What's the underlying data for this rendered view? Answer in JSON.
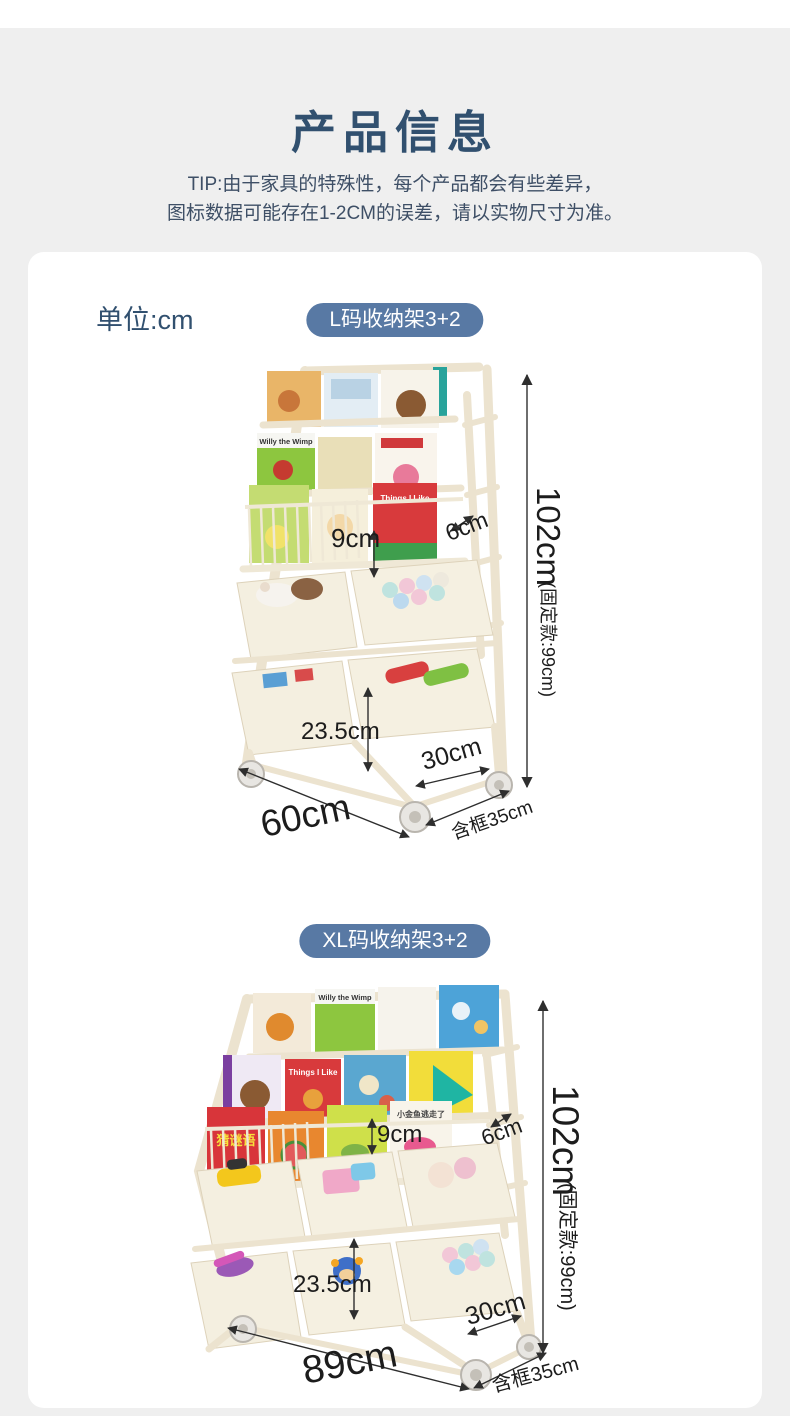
{
  "header": {
    "title": "产品信息",
    "tip_line1": "TIP:由于家具的特殊性，每个产品都会有些差异，",
    "tip_line2": "图标数据可能存在1-2CM的误差，请以实物尺寸为准。"
  },
  "unit_label": "单位:cm",
  "colors": {
    "accent": "#5879a4",
    "title_text": "#31506f",
    "tip_text": "#3e4f66",
    "dim_text": "#1c1c1c",
    "page_bg": "#efefef",
    "card_bg": "#ffffff"
  },
  "section_l": {
    "badge": "L码收纳架3+2",
    "dimensions": {
      "height": "102cm",
      "height_note": "(固定款:99cm)",
      "pocket_depth": "9cm",
      "top_gap": "6cm",
      "bin_height": "23.5cm",
      "bin_depth": "30cm",
      "width": "60cm",
      "depth_with_frame": "含框35cm"
    },
    "book_titles": {
      "willy": "Willy the Wimp",
      "things": "Things I Like"
    }
  },
  "section_xl": {
    "badge": "XL码收纳架3+2",
    "dimensions": {
      "height": "102cm",
      "height_note": "(固定款:99cm)",
      "pocket_depth": "9cm",
      "top_gap": "6cm",
      "bin_height": "23.5cm",
      "bin_depth": "30cm",
      "width": "89cm",
      "depth_with_frame": "含框35cm"
    },
    "book_titles": {
      "willy": "Willy the Wimp",
      "things": "Things I Like",
      "riddle": "猜谜语",
      "fish": "小金鱼逃走了"
    }
  }
}
